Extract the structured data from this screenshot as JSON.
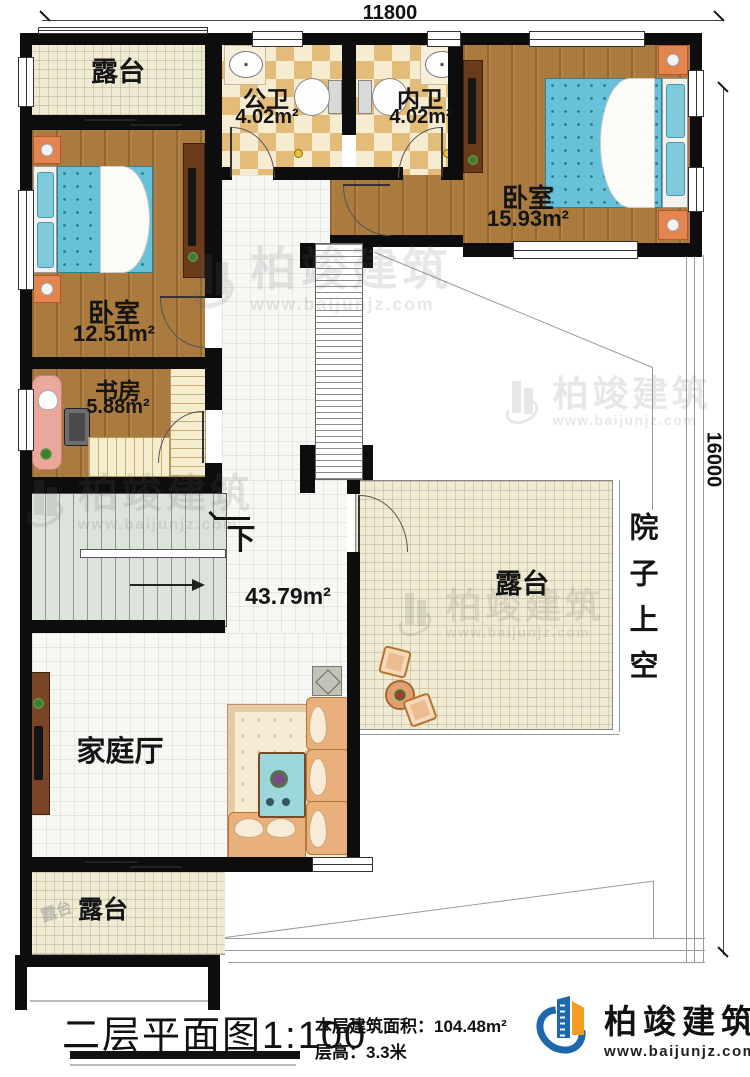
{
  "dimensions": {
    "top": "11800",
    "right": "16000"
  },
  "rooms": {
    "terrace_top": {
      "label": "露台"
    },
    "public_bath": {
      "label": "公卫",
      "area": "4.02m²"
    },
    "private_bath": {
      "label": "内卫",
      "area": "4.02m²"
    },
    "bedroom_right": {
      "label": "卧室",
      "area": "15.93m²"
    },
    "bedroom_left": {
      "label": "卧室",
      "area": "12.51m²"
    },
    "study": {
      "label": "书房",
      "area": "5.88m²"
    },
    "hall": {
      "label": "家庭厅",
      "area": "43.79m²"
    },
    "terrace_mid": {
      "label": "露台"
    },
    "terrace_bottom": {
      "label": "露台"
    },
    "courtyard": {
      "label": "院子上空"
    },
    "stairs": {
      "down_label": "下"
    }
  },
  "watermark": {
    "brand": "柏竣建筑",
    "url": "www.baijunjz.com",
    "terrace_small": "露台"
  },
  "footer": {
    "title": "二层平面图",
    "scale": "1:100",
    "area_line": "本层建筑面积：104.48m²",
    "height_line": "层高：3.3米",
    "brand": "柏竣建筑",
    "url": "www.baijunjz.com"
  },
  "colors": {
    "wall": "#0d0d0d",
    "wood": "#ab7a3e",
    "tile": "#eeead4",
    "white_tile": "#f7f7f4",
    "checker_light": "#f6ecd1",
    "checker_dark": "#e3bc79",
    "stair": "#dce3db",
    "mattress": "#67c1d8",
    "nightstand": "#e2854f",
    "sofa": "#eab07c",
    "brand_blue": "#1d67ad",
    "brand_orange": "#f59d20"
  }
}
